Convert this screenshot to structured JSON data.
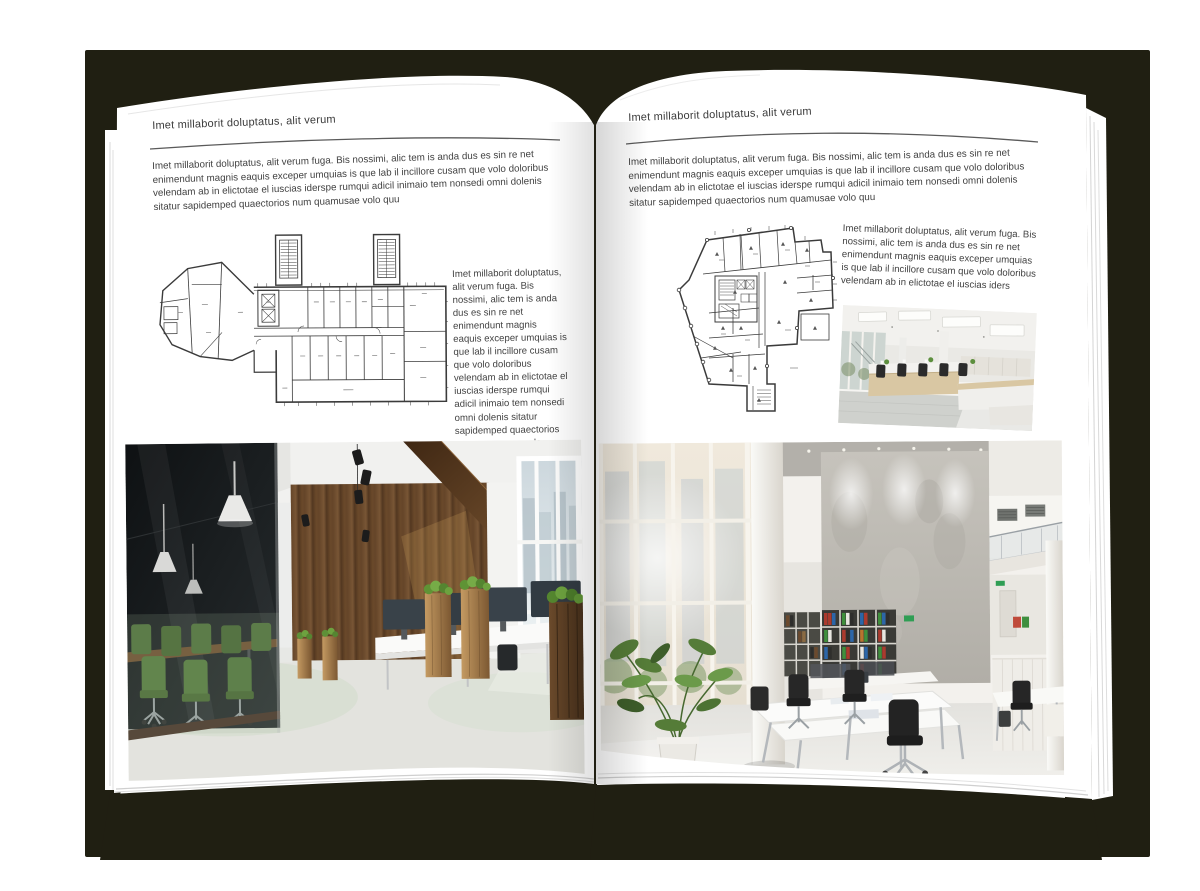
{
  "background_color": "#ffffff",
  "book": {
    "cover_color": "#201f12",
    "page_color": "#ffffff",
    "text_color": "#3d3d3d"
  },
  "left_page": {
    "header": "Imet millaborit doluptatus, alit verum",
    "intro": "Imet millaborit doluptatus, alit verum fuga. Bis nossimi, alic tem is anda dus es sin re net enimendunt magnis eaquis exceper umquias is que lab il incillore cusam que volo doloribus velendam ab in elictotae el iuscias iderspe rumqui adicil inimaio tem nonsedi omni dolenis sitatur sapidemped quaectorios num quamusae volo quu",
    "side_text": "Imet millaborit doluptatus, alit verum fuga. Bis nossimi, alic tem is anda dus es sin re net enimendunt magnis eaquis exceper umquias is que lab il incillore cusam que volo doloribus velendam ab in elictotae el iuscias iderspe rumqui adicil inimaio tem nonsedi omni dolenis sitatur sapidemped quaectorios num quamusae volo quu",
    "photo_description": "Loft office interior with dark glass meeting room, green chairs, wooden wall, planters and city windows"
  },
  "right_page": {
    "header": "Imet millaborit doluptatus, alit verum",
    "intro": "Imet millaborit doluptatus, alit verum fuga. Bis nossimi, alic tem is anda dus es sin re net enimendunt magnis eaquis exceper umquias is que lab il incillore cusam que volo doloribus velendam ab in elictotae el iuscias iderspe rumqui adicil inimaio tem nonsedi omni dolenis sitatur sapidemped quaectorios num quamusae volo quu",
    "side_text": "Imet millaborit doluptatus, alit verum fuga. Bis nossimi, alic tem is anda dus es sin re net enimendunt magnis eaquis exceper umquias is que lab il incillore cusam que volo doloribus velendam ab in elictotae el iuscias iders",
    "photo_small_description": "Bright open-plan office with rows of light wood desks and black chairs",
    "photo_description": "White double-height office atrium with glass facade, concrete wall, binder shelves and desks"
  }
}
